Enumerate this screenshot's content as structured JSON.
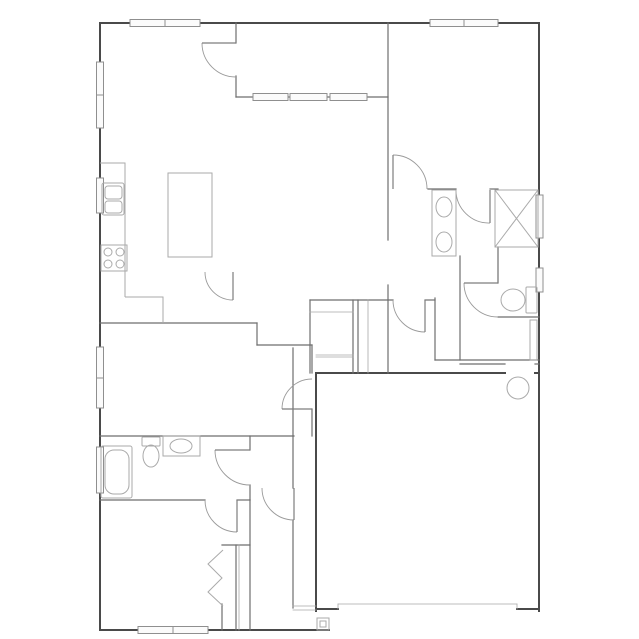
{
  "meta": {
    "title": "house-floor-plan",
    "background": "#ffffff",
    "colors": {
      "wall_exterior": "#4a4a4a",
      "wall_interior": "#6e6e6e",
      "wall_thin": "#a8a8a8",
      "door": "#9a9a9a",
      "door_leaf": "#7d7d7d",
      "fixture": "#aaaaaa",
      "fixture_light": "#c4c4c4",
      "window_stroke": "#8f8f8f",
      "window_fill": "#fbfbfb"
    }
  },
  "plan": {
    "width": 639,
    "height": 639,
    "walls": [
      {
        "name": "wall-exterior-top",
        "t": "ext",
        "x1": 100,
        "y1": 23,
        "x2": 539,
        "y2": 23
      },
      {
        "name": "wall-exterior-right",
        "t": "ext",
        "x1": 539,
        "y1": 23,
        "x2": 539,
        "y2": 611
      },
      {
        "name": "wall-exterior-left",
        "t": "ext",
        "x1": 100,
        "y1": 23,
        "x2": 100,
        "y2": 630
      },
      {
        "name": "wall-exterior-bottom-bedroom",
        "t": "ext",
        "x1": 100,
        "y1": 630,
        "x2": 329,
        "y2": 630
      },
      {
        "name": "wall-garage-bottom-left",
        "t": "ext",
        "x1": 316,
        "y1": 609,
        "x2": 338,
        "y2": 609
      },
      {
        "name": "wall-garage-bottom-right",
        "t": "ext",
        "x1": 517,
        "y1": 609,
        "x2": 539,
        "y2": 609
      },
      {
        "name": "wall-garage-left",
        "t": "ext",
        "x1": 316,
        "y1": 373,
        "x2": 316,
        "y2": 611
      },
      {
        "name": "wall-garage-top-a",
        "t": "ext",
        "x1": 316,
        "y1": 373,
        "x2": 505,
        "y2": 373
      },
      {
        "name": "wall-garage-top-b",
        "t": "ext",
        "x1": 535,
        "y1": 373,
        "x2": 539,
        "y2": 373
      },
      {
        "name": "wall-entry-left-upper",
        "t": "int",
        "x1": 293,
        "y1": 348,
        "x2": 293,
        "y2": 488
      },
      {
        "name": "wall-entry-left-lower",
        "t": "int",
        "x1": 293,
        "y1": 520,
        "x2": 293,
        "y2": 608
      },
      {
        "name": "front-door-threshold-a",
        "t": "thin",
        "x1": 293,
        "y1": 606,
        "x2": 316,
        "y2": 606
      },
      {
        "name": "front-door-threshold-b",
        "t": "thin",
        "x1": 293,
        "y1": 610,
        "x2": 316,
        "y2": 610
      },
      {
        "name": "wall-master-west-upper",
        "t": "int",
        "x1": 388,
        "y1": 23,
        "x2": 388,
        "y2": 240
      },
      {
        "name": "wall-master-west-lower",
        "t": "int",
        "x1": 388,
        "y1": 285,
        "x2": 388,
        "y2": 373
      },
      {
        "name": "wall-patio-left-top",
        "t": "int",
        "x1": 236,
        "y1": 23,
        "x2": 236,
        "y2": 43
      },
      {
        "name": "wall-patio-left-bottom",
        "t": "int",
        "x1": 236,
        "y1": 76,
        "x2": 236,
        "y2": 97
      },
      {
        "name": "wall-patio-sill",
        "t": "int",
        "x1": 236,
        "y1": 97,
        "x2": 388,
        "y2": 97
      },
      {
        "name": "wall-master-south-a",
        "t": "int",
        "x1": 428,
        "y1": 189,
        "x2": 456,
        "y2": 189
      },
      {
        "name": "wall-master-south-b",
        "t": "int",
        "x1": 490,
        "y1": 189,
        "x2": 498,
        "y2": 189
      },
      {
        "name": "wall-hall-south",
        "t": "int",
        "x1": 310,
        "y1": 300,
        "x2": 393,
        "y2": 300
      },
      {
        "name": "wall-hall-stub",
        "t": "int",
        "x1": 425,
        "y1": 300,
        "x2": 435,
        "y2": 300
      },
      {
        "name": "wall-corridor-right",
        "t": "int",
        "x1": 435,
        "y1": 298,
        "x2": 435,
        "y2": 360
      },
      {
        "name": "wall-hallcloset-left",
        "t": "int",
        "x1": 310,
        "y1": 300,
        "x2": 310,
        "y2": 373
      },
      {
        "name": "wall-hallcloset-mid1",
        "t": "int",
        "x1": 353,
        "y1": 300,
        "x2": 353,
        "y2": 373
      },
      {
        "name": "wall-hallcloset-mid2",
        "t": "int",
        "x1": 358,
        "y1": 300,
        "x2": 358,
        "y2": 373
      },
      {
        "name": "wall-hallcloset-right",
        "t": "thin",
        "x1": 368,
        "y1": 300,
        "x2": 368,
        "y2": 373
      },
      {
        "name": "shelf-hallcloset-top",
        "t": "thin",
        "x1": 310,
        "y1": 312,
        "x2": 353,
        "y2": 312
      },
      {
        "name": "shelf-hallcloset-bot-a",
        "t": "thin",
        "x1": 316,
        "y1": 355,
        "x2": 353,
        "y2": 355
      },
      {
        "name": "shelf-hallcloset-bot-b",
        "t": "thin",
        "x1": 316,
        "y1": 357,
        "x2": 353,
        "y2": 357
      },
      {
        "name": "wall-kitchen-south",
        "t": "int",
        "x1": 100,
        "y1": 323,
        "x2": 257,
        "y2": 323
      },
      {
        "name": "wall-bedroom3-step",
        "t": "int",
        "x1": 257,
        "y1": 323,
        "x2": 257,
        "y2": 345
      },
      {
        "name": "wall-bedroom3-top",
        "t": "int",
        "x1": 257,
        "y1": 345,
        "x2": 312,
        "y2": 345
      },
      {
        "name": "wall-bedroom3-right-a",
        "t": "int",
        "x1": 312,
        "y1": 345,
        "x2": 312,
        "y2": 373
      },
      {
        "name": "wall-bedroom3-right-b",
        "t": "int",
        "x1": 312,
        "y1": 409,
        "x2": 312,
        "y2": 436
      },
      {
        "name": "wall-bath2-top",
        "t": "int",
        "x1": 100,
        "y1": 436,
        "x2": 294,
        "y2": 436
      },
      {
        "name": "wall-bath2-right-a",
        "t": "int",
        "x1": 250,
        "y1": 436,
        "x2": 250,
        "y2": 450
      },
      {
        "name": "wall-bath2-right-b",
        "t": "int",
        "x1": 250,
        "y1": 485,
        "x2": 250,
        "y2": 500
      },
      {
        "name": "wall-bedroom2-top-a",
        "t": "int",
        "x1": 100,
        "y1": 500,
        "x2": 205,
        "y2": 500
      },
      {
        "name": "wall-bedroom2-top-b",
        "t": "int",
        "x1": 237,
        "y1": 500,
        "x2": 250,
        "y2": 500
      },
      {
        "name": "wall-bedroom2-right",
        "t": "int",
        "x1": 250,
        "y1": 500,
        "x2": 250,
        "y2": 630
      },
      {
        "name": "wall-wc-left",
        "t": "int",
        "x1": 498,
        "y1": 247,
        "x2": 498,
        "y2": 283
      },
      {
        "name": "wall-wc-bottom",
        "t": "int",
        "x1": 498,
        "y1": 317,
        "x2": 539,
        "y2": 317
      },
      {
        "name": "wall-laundry-left",
        "t": "int",
        "x1": 460,
        "y1": 256,
        "x2": 460,
        "y2": 360
      },
      {
        "name": "wall-laundry-bottom",
        "t": "int",
        "x1": 435,
        "y1": 360,
        "x2": 539,
        "y2": 360
      },
      {
        "name": "wall-laundry-garage-a",
        "t": "int",
        "x1": 460,
        "y1": 364,
        "x2": 505,
        "y2": 364
      },
      {
        "name": "wall-laundry-garage-b",
        "t": "int",
        "x1": 535,
        "y1": 364,
        "x2": 539,
        "y2": 364
      },
      {
        "name": "wall-closet2-top",
        "t": "int",
        "x1": 222,
        "y1": 545,
        "x2": 250,
        "y2": 545
      },
      {
        "name": "wall-closet2-back-a",
        "t": "int",
        "x1": 236,
        "y1": 545,
        "x2": 236,
        "y2": 630
      },
      {
        "name": "wall-closet2-back-b",
        "t": "thin",
        "x1": 239,
        "y1": 545,
        "x2": 239,
        "y2": 630
      },
      {
        "name": "wall-closet2-front-stub",
        "t": "int",
        "x1": 222,
        "y1": 604,
        "x2": 222,
        "y2": 630
      },
      {
        "name": "garage-door-panel",
        "t": "thin",
        "x1": 338,
        "y1": 604,
        "x2": 517,
        "y2": 604
      },
      {
        "name": "garage-door-jamb-left",
        "t": "thin",
        "x1": 338,
        "y1": 604,
        "x2": 338,
        "y2": 609
      },
      {
        "name": "garage-door-jamb-right",
        "t": "thin",
        "x1": 517,
        "y1": 604,
        "x2": 517,
        "y2": 609
      }
    ],
    "windows": [
      {
        "name": "window-greatroom-top",
        "x": 130,
        "y": 19.5,
        "w": 70,
        "h": 7,
        "split": "v:165"
      },
      {
        "name": "window-master-top",
        "x": 430,
        "y": 19.5,
        "w": 68,
        "h": 7,
        "split": "v:464"
      },
      {
        "name": "window-greatroom-left",
        "x": 96.5,
        "y": 62,
        "w": 7,
        "h": 66,
        "split": "h:95"
      },
      {
        "name": "window-kitchen-sink",
        "x": 96.5,
        "y": 178,
        "w": 7,
        "h": 35,
        "split": ""
      },
      {
        "name": "window-bedroom3-left",
        "x": 96.5,
        "y": 347,
        "w": 7,
        "h": 61,
        "split": "h:378"
      },
      {
        "name": "window-bath2-left",
        "x": 96.5,
        "y": 447,
        "w": 7,
        "h": 46,
        "split": ""
      },
      {
        "name": "window-shower-right",
        "x": 536,
        "y": 195,
        "w": 7,
        "h": 43,
        "split": ""
      },
      {
        "name": "window-wc-right",
        "x": 536,
        "y": 268,
        "w": 7,
        "h": 24,
        "split": ""
      },
      {
        "name": "window-patio-1",
        "x": 253,
        "y": 93.5,
        "w": 35,
        "h": 7,
        "split": ""
      },
      {
        "name": "window-patio-2",
        "x": 290,
        "y": 93.5,
        "w": 37,
        "h": 7,
        "split": ""
      },
      {
        "name": "window-patio-3",
        "x": 330,
        "y": 93.5,
        "w": 37,
        "h": 7,
        "split": ""
      },
      {
        "name": "window-bedroom2-bottom",
        "x": 138,
        "y": 626.5,
        "w": 70,
        "h": 7,
        "split": "v:173"
      }
    ],
    "doors": [
      {
        "name": "door-patio",
        "leaf": [
          202,
          43,
          236,
          43
        ],
        "arc": "M202,43 A34,34 0 0 0 236,77"
      },
      {
        "name": "door-master-bedroom",
        "leaf": [
          393,
          155,
          393,
          189
        ],
        "arc": "M393,155 A34,34 0 0 1 427,189"
      },
      {
        "name": "door-master-suite-hall",
        "leaf": [
          425,
          300,
          425,
          332
        ],
        "arc": "M393,300 A32,32 0 0 0 425,332"
      },
      {
        "name": "door-pantry",
        "leaf": [
          233,
          272,
          233,
          300
        ],
        "arc": "M205,272 A28,28 0 0 0 233,300"
      },
      {
        "name": "door-bedroom3",
        "leaf": [
          282,
          409,
          312,
          409
        ],
        "arc": "M312,379 A30,30 0 0 0 282,409"
      },
      {
        "name": "door-bath2",
        "leaf": [
          215,
          450,
          250,
          450
        ],
        "arc": "M215,450 A35,35 0 0 0 250,485"
      },
      {
        "name": "door-hall-pocket",
        "leaf": [
          294,
          488,
          294,
          520
        ],
        "arc": "M262,488 A32,32 0 0 0 294,520"
      },
      {
        "name": "door-bedroom2",
        "leaf": [
          237,
          500,
          237,
          532
        ],
        "arc": "M205,500 A32,32 0 0 0 237,532"
      },
      {
        "name": "door-master-bath",
        "leaf": [
          490,
          190,
          490,
          223
        ],
        "arc": "M456,190 A33,33 0 0 0 490,223"
      },
      {
        "name": "door-water-closet",
        "leaf": [
          464,
          283,
          498,
          283
        ],
        "arc": "M464,283 A34,34 0 0 0 498,317"
      }
    ],
    "fixtures": [
      {
        "name": "kitchen-counter-upper",
        "type": "polyline",
        "pts": [
          [
            100,
            163
          ],
          [
            125,
            163
          ],
          [
            125,
            297
          ]
        ]
      },
      {
        "name": "kitchen-counter-lower",
        "type": "polyline",
        "pts": [
          [
            125,
            297
          ],
          [
            163,
            297
          ],
          [
            163,
            323
          ]
        ]
      },
      {
        "name": "kitchen-sink-outer",
        "type": "rect",
        "x": 102,
        "y": 183,
        "w": 22,
        "h": 32,
        "r": 2
      },
      {
        "name": "kitchen-sink-bowl-1",
        "type": "rect",
        "x": 105,
        "y": 186,
        "w": 17,
        "h": 13,
        "r": 3
      },
      {
        "name": "kitchen-sink-bowl-2",
        "type": "rect",
        "x": 105,
        "y": 201,
        "w": 17,
        "h": 12,
        "r": 3
      },
      {
        "name": "stove",
        "type": "rect",
        "x": 101,
        "y": 245,
        "w": 26,
        "h": 26,
        "r": 0
      },
      {
        "name": "stove-burner-1",
        "type": "circle",
        "cx": 108,
        "cy": 252,
        "r": 4
      },
      {
        "name": "stove-burner-2",
        "type": "circle",
        "cx": 120,
        "cy": 252,
        "r": 4
      },
      {
        "name": "stove-burner-3",
        "type": "circle",
        "cx": 108,
        "cy": 264,
        "r": 4
      },
      {
        "name": "stove-burner-4",
        "type": "circle",
        "cx": 120,
        "cy": 264,
        "r": 4
      },
      {
        "name": "kitchen-island",
        "type": "rect",
        "x": 168,
        "y": 173,
        "w": 44,
        "h": 84,
        "r": 0
      },
      {
        "name": "bathtub-outer",
        "type": "rect",
        "x": 101,
        "y": 446,
        "w": 31,
        "h": 52,
        "r": 2
      },
      {
        "name": "bathtub-inner",
        "type": "rect",
        "x": 105,
        "y": 450,
        "w": 24,
        "h": 44,
        "r": 9
      },
      {
        "name": "toilet-bath2-tank",
        "type": "rect",
        "x": 142,
        "y": 437,
        "w": 18,
        "h": 9,
        "r": 1
      },
      {
        "name": "toilet-bath2-bowl",
        "type": "ellipse",
        "cx": 151,
        "cy": 456,
        "rx": 8,
        "ry": 11
      },
      {
        "name": "vanity-bath2",
        "type": "rect",
        "x": 163,
        "y": 436,
        "w": 37,
        "h": 20,
        "r": 0
      },
      {
        "name": "sink-bath2",
        "type": "ellipse",
        "cx": 181,
        "cy": 446,
        "rx": 11,
        "ry": 7
      },
      {
        "name": "vanity-master",
        "type": "rect",
        "x": 432,
        "y": 190,
        "w": 24,
        "h": 66,
        "r": 0
      },
      {
        "name": "sink-master-1",
        "type": "ellipse",
        "cx": 444,
        "cy": 207,
        "rx": 8,
        "ry": 10
      },
      {
        "name": "sink-master-2",
        "type": "ellipse",
        "cx": 444,
        "cy": 242,
        "rx": 8,
        "ry": 10
      },
      {
        "name": "shower-box",
        "type": "rect",
        "x": 495,
        "y": 190,
        "w": 43,
        "h": 57,
        "r": 0
      },
      {
        "name": "shower-x-1",
        "type": "polyline",
        "pts": [
          [
            495,
            190
          ],
          [
            538,
            247
          ]
        ]
      },
      {
        "name": "shower-x-2",
        "type": "polyline",
        "pts": [
          [
            538,
            190
          ],
          [
            495,
            247
          ]
        ]
      },
      {
        "name": "toilet-wc-tank",
        "type": "rect",
        "x": 526,
        "y": 287,
        "w": 11,
        "h": 26,
        "r": 1
      },
      {
        "name": "toilet-wc-bowl",
        "type": "ellipse",
        "cx": 513,
        "cy": 300,
        "rx": 12,
        "ry": 11
      },
      {
        "name": "water-heater",
        "type": "circle",
        "cx": 518,
        "cy": 388,
        "r": 11
      },
      {
        "name": "laundry-door-leaf",
        "type": "rect",
        "x": 530,
        "y": 320,
        "w": 7,
        "h": 40,
        "r": 0
      },
      {
        "name": "porch-post-outer",
        "type": "rect",
        "x": 317,
        "y": 618,
        "w": 12,
        "h": 12,
        "r": 0
      },
      {
        "name": "porch-post-inner",
        "type": "rect",
        "x": 320,
        "y": 621,
        "w": 6,
        "h": 6,
        "r": 0
      },
      {
        "name": "closet2-bifold-door",
        "type": "polyline",
        "pts": [
          [
            223,
            550
          ],
          [
            208,
            564
          ],
          [
            222,
            578
          ],
          [
            208,
            592
          ],
          [
            223,
            606
          ]
        ]
      }
    ]
  }
}
